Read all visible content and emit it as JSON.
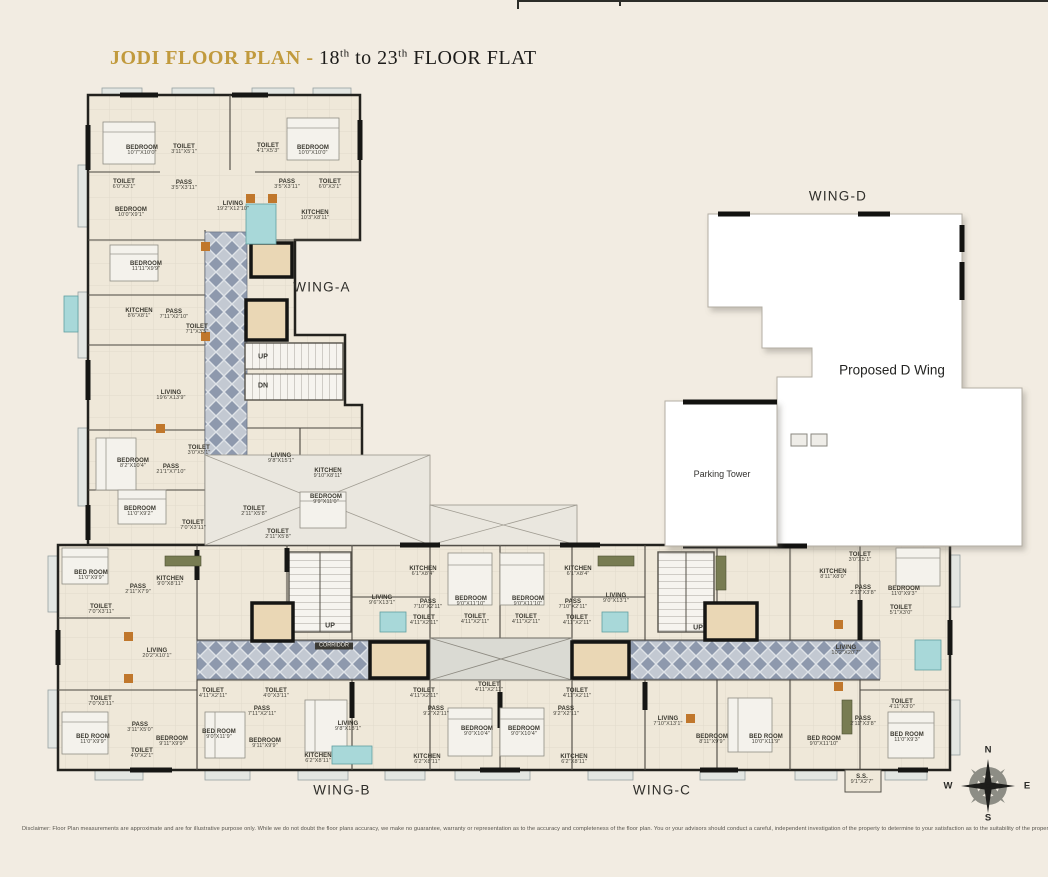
{
  "title": {
    "brand": "JODI FLOOR PLAN",
    "separator": " - ",
    "floor_start": "18",
    "floor_start_sup": "th",
    "to": " to ",
    "floor_end": "23",
    "floor_end_sup": "th",
    "suffix": " FLOOR  FLAT"
  },
  "disclaimer": "Disclaimer: Floor Plan measurements are approximate and are for illustrative purpose only. While we do not doubt the floor plans accuracy, we make no guarantee, warranty or representation as to the accuracy and completeness of the floor plan. You or your advisors should conduct a careful, independent investigation of the property to determine to your satisfaction as to the suitability of the property for your space requirements.",
  "colors": {
    "background": "#f2ece2",
    "title_gold": "#c19a3d",
    "title_dark": "#1d1c1a",
    "wall_dark": "#1c1b19",
    "floor": "#efe8d9",
    "corridor_diamond": "#8e99ad",
    "corridor_base": "#c3c9d2",
    "lift_fill": "#ead7b5",
    "white_wing": "#ffffff",
    "teal_furniture": "#a8d8d9",
    "wood_accent": "#c0772c"
  },
  "plan": {
    "labels": [
      {
        "t": "WING-A",
        "x": 322,
        "y": 287,
        "c": "wing",
        "n": "wing-a-label"
      },
      {
        "t": "WING-B",
        "x": 342,
        "y": 790,
        "c": "wing",
        "n": "wing-b-label"
      },
      {
        "t": "WING-C",
        "x": 662,
        "y": 790,
        "c": "wing",
        "n": "wing-c-label"
      },
      {
        "t": "WING-D",
        "x": 838,
        "y": 196,
        "c": "wing",
        "n": "wing-d-label"
      },
      {
        "t": "Proposed D Wing",
        "x": 892,
        "y": 370,
        "c": "blocklg",
        "n": "proposed-d-wing-label"
      },
      {
        "t": "Parking Tower",
        "x": 722,
        "y": 474,
        "c": "blocksm",
        "n": "parking-tower-label"
      },
      {
        "t": "UP",
        "x": 263,
        "y": 357,
        "c": "stair",
        "n": "stairs-up-label"
      },
      {
        "t": "DN",
        "x": 263,
        "y": 386,
        "c": "stair",
        "n": "stairs-dn-label"
      },
      {
        "t": "UP",
        "x": 330,
        "y": 626,
        "c": "stair",
        "n": "stairs-up-label"
      },
      {
        "t": "UP",
        "x": 698,
        "y": 628,
        "c": "stair",
        "n": "stairs-up-label"
      },
      {
        "t": "CORRIDOR",
        "x": 334,
        "y": 646,
        "c": "tag",
        "n": "corridor-label"
      },
      {
        "t": "N",
        "x": 988,
        "y": 750,
        "c": "compass",
        "n": "compass-north"
      },
      {
        "t": "S",
        "x": 988,
        "y": 818,
        "c": "compass",
        "n": "compass-south"
      },
      {
        "t": "W",
        "x": 948,
        "y": 786,
        "c": "compass",
        "n": "compass-west"
      },
      {
        "t": "E",
        "x": 1027,
        "y": 786,
        "c": "compass",
        "n": "compass-east"
      },
      {
        "t": "BEDROOM",
        "d": "10'7\"X10'0\"",
        "x": 142,
        "y": 151
      },
      {
        "t": "TOILET",
        "d": "3'11\"X5'1\"",
        "x": 184,
        "y": 150
      },
      {
        "t": "TOILET",
        "d": "4'1\"X5'3\"",
        "x": 268,
        "y": 149
      },
      {
        "t": "BEDROOM",
        "d": "10'0\"X10'0\"",
        "x": 313,
        "y": 151
      },
      {
        "t": "TOILET",
        "d": "6'0\"X3'1\"",
        "x": 124,
        "y": 185
      },
      {
        "t": "PASS",
        "d": "3'5\"X3'11\"",
        "x": 184,
        "y": 186
      },
      {
        "t": "PASS",
        "d": "3'5\"X3'11\"",
        "x": 287,
        "y": 185
      },
      {
        "t": "TOILET",
        "d": "6'0\"X3'1\"",
        "x": 330,
        "y": 185
      },
      {
        "t": "BEDROOM",
        "d": "10'0\"X9'1\"",
        "x": 131,
        "y": 213
      },
      {
        "t": "LIVING",
        "d": "19'2\"X12'10\"",
        "x": 233,
        "y": 207
      },
      {
        "t": "KITCHEN",
        "d": "10'3\"X8'11\"",
        "x": 315,
        "y": 216
      },
      {
        "t": "BEDROOM",
        "d": "11'11\"X9'9\"",
        "x": 146,
        "y": 267
      },
      {
        "t": "KITCHEN",
        "d": "8'6\"X8'1\"",
        "x": 139,
        "y": 314
      },
      {
        "t": "PASS",
        "d": "7'11\"X2'10\"",
        "x": 174,
        "y": 315
      },
      {
        "t": "TOILET",
        "d": "7'1\"X3'5\"",
        "x": 197,
        "y": 330
      },
      {
        "t": "LIVING",
        "d": "19'6\"X13'9\"",
        "x": 171,
        "y": 396
      },
      {
        "t": "BEDROOM",
        "d": "8'2\"X10'4\"",
        "x": 133,
        "y": 464
      },
      {
        "t": "PASS",
        "d": "21'1\"X7'10\"",
        "x": 171,
        "y": 470
      },
      {
        "t": "TOILET",
        "d": "3'0\"X5'1\"",
        "x": 199,
        "y": 451
      },
      {
        "t": "LIVING",
        "d": "9'8\"X15'1\"",
        "x": 281,
        "y": 459
      },
      {
        "t": "KITCHEN",
        "d": "9'10\"X8'11\"",
        "x": 328,
        "y": 474
      },
      {
        "t": "BEDROOM",
        "d": "9'9\"X11'0\"",
        "x": 326,
        "y": 500
      },
      {
        "t": "BEDROOM",
        "d": "11'0\"X9'2\"",
        "x": 140,
        "y": 512
      },
      {
        "t": "TOILET",
        "d": "2'11\"X5'8\"",
        "x": 254,
        "y": 512
      },
      {
        "t": "TOILET",
        "d": "7'0\"X3'11\"",
        "x": 193,
        "y": 526
      },
      {
        "t": "TOILET",
        "d": "2'11\"X5'8\"",
        "x": 278,
        "y": 535
      },
      {
        "t": "BED ROOM",
        "d": "11'0\"X9'9\"",
        "x": 91,
        "y": 576
      },
      {
        "t": "KITCHEN",
        "d": "9'0\"X8'11\"",
        "x": 170,
        "y": 582
      },
      {
        "t": "PASS",
        "d": "2'11\"X7'9\"",
        "x": 138,
        "y": 590
      },
      {
        "t": "TOILET",
        "d": "7'0\"X3'11\"",
        "x": 101,
        "y": 610
      },
      {
        "t": "LIVING",
        "d": "20'2\"X10'1\"",
        "x": 157,
        "y": 654
      },
      {
        "t": "TOILET",
        "d": "7'0\"X3'11\"",
        "x": 101,
        "y": 702
      },
      {
        "t": "PASS",
        "d": "3'11\"X5'0\"",
        "x": 140,
        "y": 728
      },
      {
        "t": "BED ROOM",
        "d": "11'0\"X9'9\"",
        "x": 93,
        "y": 740
      },
      {
        "t": "TOILET",
        "d": "4'0\"X2'1\"",
        "x": 142,
        "y": 754
      },
      {
        "t": "BEDROOM",
        "d": "9'11\"X9'9\"",
        "x": 172,
        "y": 742
      },
      {
        "t": "TOILET",
        "d": "4'11\"X2'11\"",
        "x": 213,
        "y": 694
      },
      {
        "t": "PASS",
        "d": "7'11\"X2'11\"",
        "x": 262,
        "y": 712
      },
      {
        "t": "BED ROOM",
        "d": "9'0\"X11'9\"",
        "x": 219,
        "y": 735
      },
      {
        "t": "BEDROOM",
        "d": "9'11\"X9'9\"",
        "x": 265,
        "y": 744
      },
      {
        "t": "TOILET",
        "d": "4'0\"X3'11\"",
        "x": 276,
        "y": 694
      },
      {
        "t": "LIVING",
        "d": "9'8\"X13'1\"",
        "x": 348,
        "y": 727
      },
      {
        "t": "KITCHEN",
        "d": "6'2\"X8'11\"",
        "x": 318,
        "y": 759
      },
      {
        "t": "LIVING",
        "d": "9'6\"X13'1\"",
        "x": 382,
        "y": 601
      },
      {
        "t": "KITCHEN",
        "d": "6'1\"X8'4\"",
        "x": 423,
        "y": 572
      },
      {
        "t": "PASS",
        "d": "7'10\"X2'11\"",
        "x": 428,
        "y": 605
      },
      {
        "t": "BEDROOM",
        "d": "9'0\"X11'10\"",
        "x": 471,
        "y": 602
      },
      {
        "t": "BEDROOM",
        "d": "9'0\"X11'10\"",
        "x": 528,
        "y": 602
      },
      {
        "t": "PASS",
        "d": "7'10\"X2'11\"",
        "x": 573,
        "y": 605
      },
      {
        "t": "KITCHEN",
        "d": "6'1\"X8'4\"",
        "x": 578,
        "y": 572
      },
      {
        "t": "LIVING",
        "d": "9'0\"X13'1\"",
        "x": 616,
        "y": 599
      },
      {
        "t": "TOILET",
        "d": "4'11\"X2'11\"",
        "x": 424,
        "y": 621
      },
      {
        "t": "TOILET",
        "d": "4'11\"X2'11\"",
        "x": 475,
        "y": 620
      },
      {
        "t": "TOILET",
        "d": "4'11\"X2'11\"",
        "x": 526,
        "y": 620
      },
      {
        "t": "TOILET",
        "d": "4'11\"X2'11\"",
        "x": 577,
        "y": 621
      },
      {
        "t": "TOILET",
        "d": "4'11\"X2'11\"",
        "x": 424,
        "y": 694
      },
      {
        "t": "TOILET",
        "d": "4'11\"X2'11\"",
        "x": 489,
        "y": 688
      },
      {
        "t": "TOILET",
        "d": "4'11\"X2'11\"",
        "x": 577,
        "y": 694
      },
      {
        "t": "PASS",
        "d": "9'2\"X2'11\"",
        "x": 436,
        "y": 712
      },
      {
        "t": "PASS",
        "d": "9'2\"X2'11\"",
        "x": 566,
        "y": 712
      },
      {
        "t": "BEDROOM",
        "d": "9'0\"X10'4\"",
        "x": 477,
        "y": 732
      },
      {
        "t": "BEDROOM",
        "d": "9'0\"X10'4\"",
        "x": 524,
        "y": 732
      },
      {
        "t": "KITCHEN",
        "d": "6'2\"X8'11\"",
        "x": 427,
        "y": 760
      },
      {
        "t": "KITCHEN",
        "d": "6'2\"X8'11\"",
        "x": 574,
        "y": 760
      },
      {
        "t": "LIVING",
        "d": "7'10\"X13'1\"",
        "x": 668,
        "y": 722
      },
      {
        "t": "KITCHEN",
        "d": "8'11\"X8'0\"",
        "x": 833,
        "y": 575
      },
      {
        "t": "TOILET",
        "d": "3'0\"X5'1\"",
        "x": 860,
        "y": 558
      },
      {
        "t": "PASS",
        "d": "2'11\"X3'8\"",
        "x": 863,
        "y": 591
      },
      {
        "t": "BEDROOM",
        "d": "11'0\"X9'3\"",
        "x": 904,
        "y": 592
      },
      {
        "t": "TOILET",
        "d": "5'1\"X3'0\"",
        "x": 901,
        "y": 611
      },
      {
        "t": "LIVING",
        "d": "10'2\"X20'7\"",
        "x": 846,
        "y": 651
      },
      {
        "t": "TOILET",
        "d": "4'11\"X3'0\"",
        "x": 902,
        "y": 705
      },
      {
        "t": "PASS",
        "d": "2'11\"X3'8\"",
        "x": 863,
        "y": 722
      },
      {
        "t": "BED ROOM",
        "d": "11'0\"X9'3\"",
        "x": 907,
        "y": 738
      },
      {
        "t": "BED ROOM",
        "d": "9'0\"X11'10\"",
        "x": 824,
        "y": 742
      },
      {
        "t": "BED ROOM",
        "d": "10'0\"X11'9\"",
        "x": 766,
        "y": 740
      },
      {
        "t": "BEDROOM",
        "d": "8'11\"X9'9\"",
        "x": 712,
        "y": 740
      },
      {
        "t": "S.S.",
        "d": "9'1\"X2'7\"",
        "x": 862,
        "y": 780
      }
    ]
  }
}
